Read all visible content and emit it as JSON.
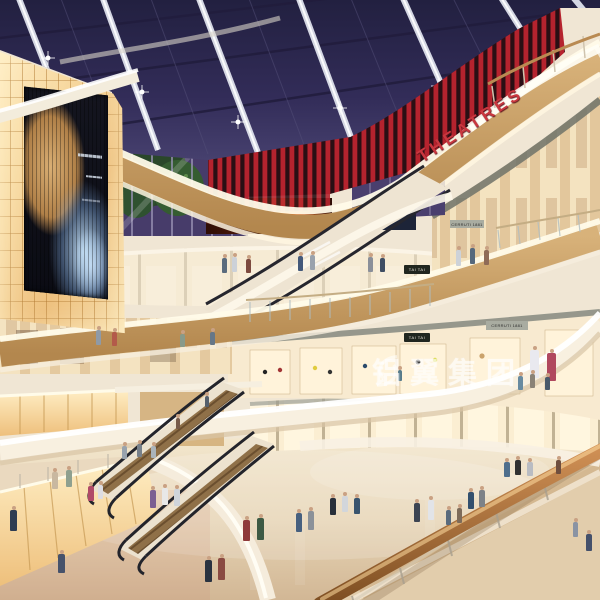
{
  "scene": {
    "title": "Shopping mall atrium interior rendering",
    "setting": "Multi-level shopping mall atrium at dusk: dark skylight grid ceiling, red cinema slat wall, curved wooden balconies with glowing fascias, criss-crossing escalators, glowing amber billboard wall and shoppers on a polished floor",
    "signs": {
      "theatres_label": "THEATRES",
      "watermark_label": "铝翼集团",
      "tai_tai_label": "TAI TAI",
      "cerruti_label": "CERRUTI 1881"
    },
    "colors": {
      "sky": "#2e2950",
      "red_slats": "#b5232e",
      "wood_fascia": "#c89f66",
      "glow_white": "#fff8e8",
      "amber_wall": "#f5d49a",
      "floor": "#e6d5ba",
      "fire_screen": "#e8681e",
      "handrail": "#a06a35"
    }
  }
}
